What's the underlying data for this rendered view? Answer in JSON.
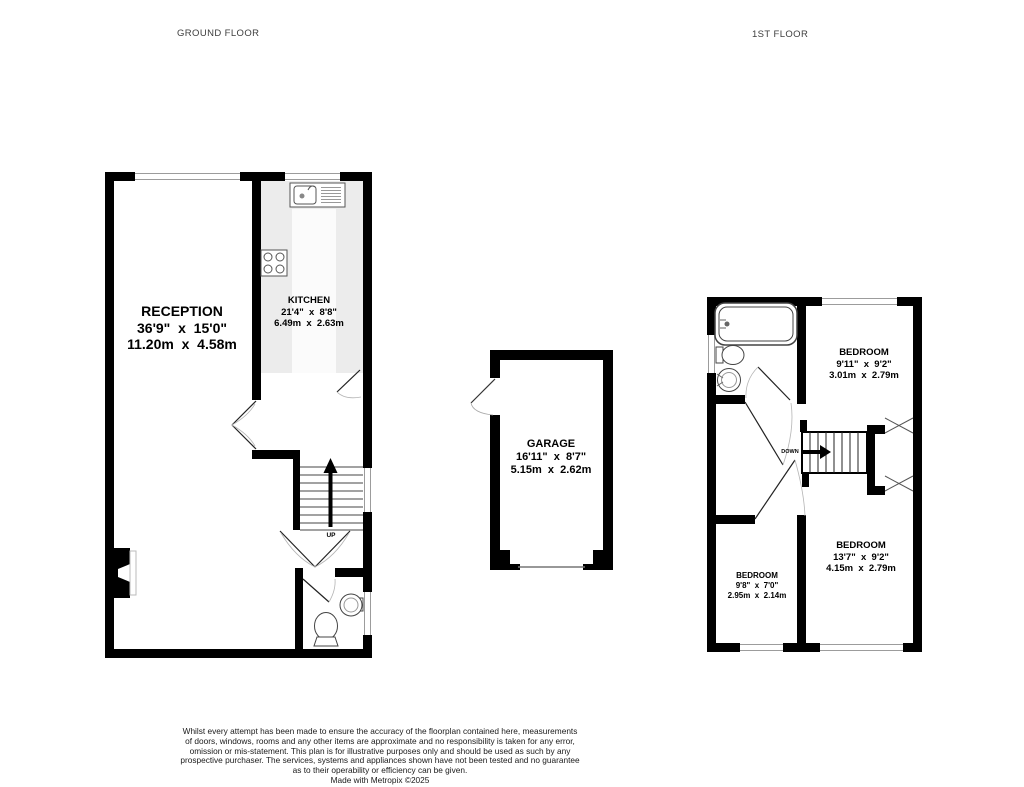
{
  "header": {
    "ground_floor": "GROUND FLOOR",
    "first_floor": "1ST FLOOR"
  },
  "ground_floor": {
    "reception": {
      "name": "RECEPTION",
      "imperial": "36'9\"  x  15'0\"",
      "metric": "11.20m  x  4.58m"
    },
    "kitchen": {
      "name": "KITCHEN",
      "imperial": "21'4\"  x  8'8\"",
      "metric": "6.49m  x  2.63m"
    },
    "stairs": {
      "direction": "UP"
    }
  },
  "garage": {
    "name": "GARAGE",
    "imperial": "16'11\"  x  8'7\"",
    "metric": "5.15m  x  2.62m"
  },
  "first_floor": {
    "bedroom_rear": {
      "name": "BEDROOM",
      "imperial": "9'11\"  x  9'2\"",
      "metric": "3.01m  x  2.79m"
    },
    "bedroom_front": {
      "name": "BEDROOM",
      "imperial": "13'7\"  x  9'2\"",
      "metric": "4.15m  x  2.79m"
    },
    "bedroom_small": {
      "name": "BEDROOM",
      "imperial": "9'8\"  x  7'0\"",
      "metric": "2.95m  x  2.14m"
    },
    "stairs": {
      "direction": "DOWN"
    }
  },
  "footer": {
    "disclaimer": [
      "Whilst every attempt has been made to ensure the accuracy of the floorplan contained here, measurements",
      "of doors, windows, rooms and any other items are approximate and no responsibility is taken for any error,",
      "omission or mis-statement. This plan is for illustrative purposes only and should be used as such by any",
      "prospective purchaser. The services, systems and appliances shown have not been tested and no guarantee",
      "as to their operability or efficiency can be given."
    ],
    "credit": "Made with Metropix ©2025"
  },
  "colors": {
    "wall": "#000000",
    "window_line": "#9c9c9c",
    "kitchen_counter": "#ececec",
    "background": "#ffffff"
  }
}
